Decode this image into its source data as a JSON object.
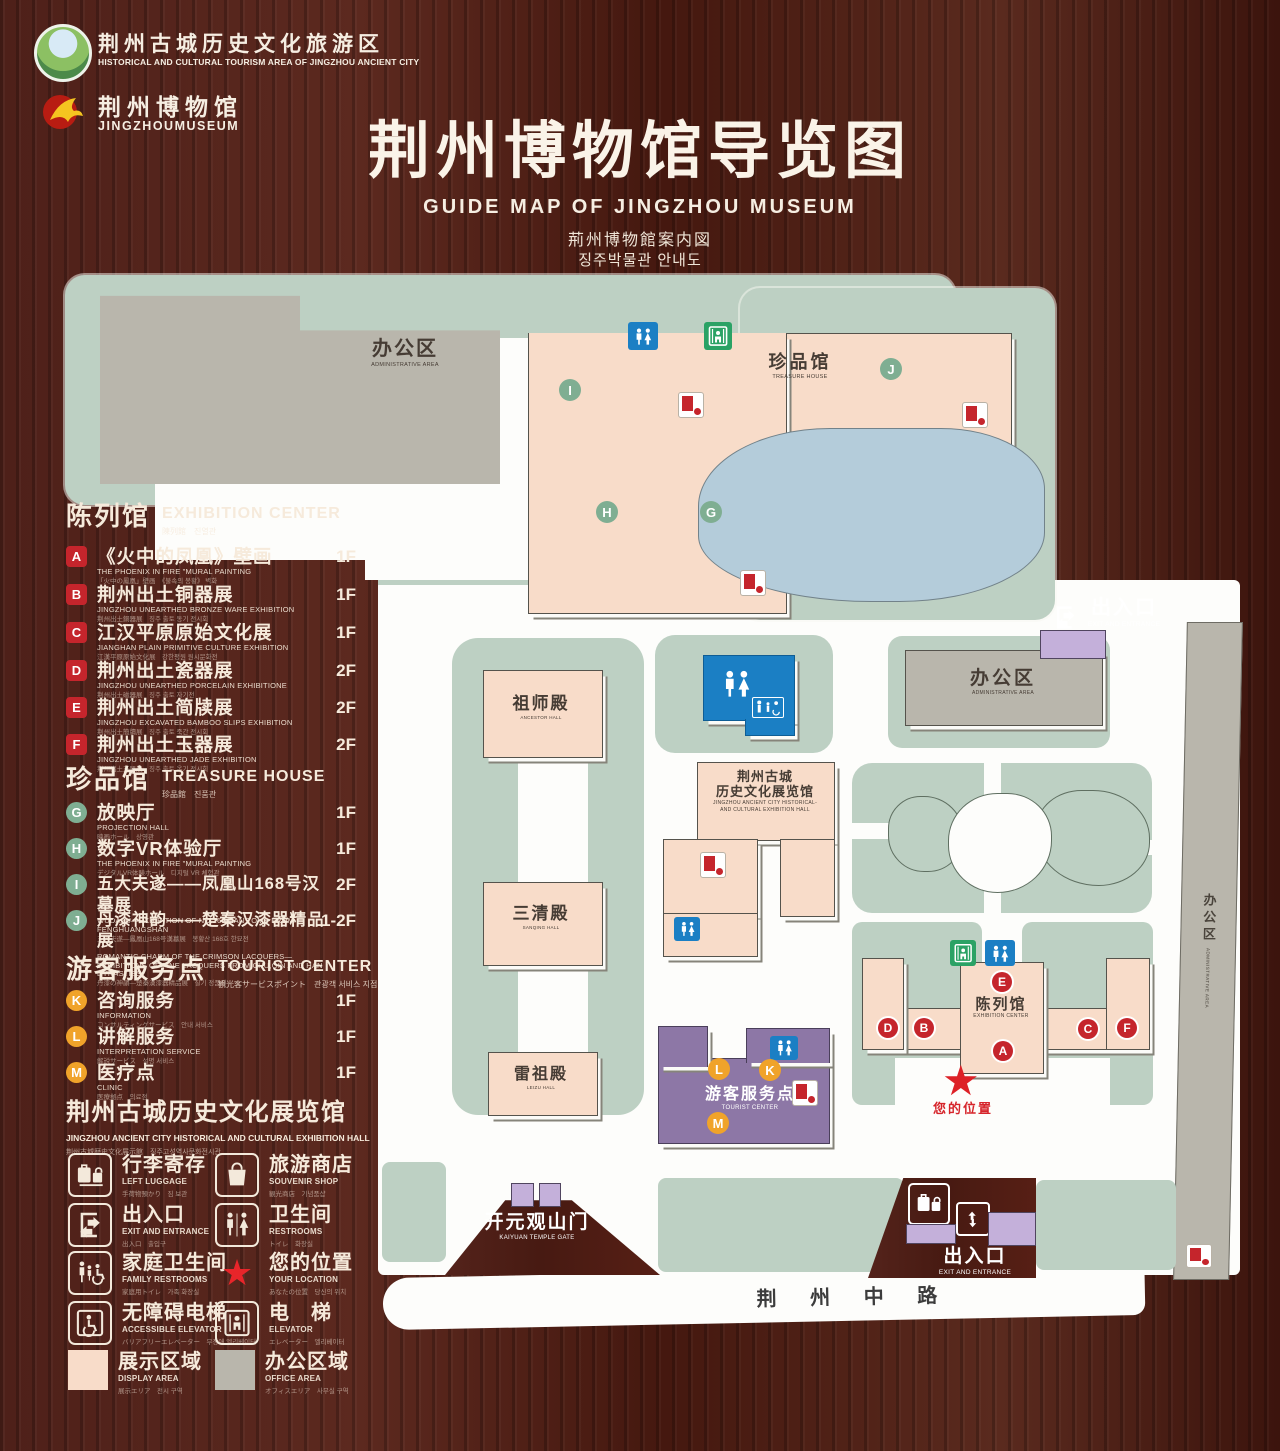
{
  "header": {
    "logo1": {
      "zh": "荆州古城历史文化旅游区",
      "en": "HISTORICAL AND CULTURAL TOURISM AREA OF JINGZHOU ANCIENT CITY"
    },
    "logo2": {
      "zh": "荆州博物馆",
      "en": "JINGZHOUMUSEUM"
    },
    "title": "荆州博物馆导览图",
    "subtitle_en": "GUIDE MAP OF JINGZHOU MUSEUM",
    "subtitle_ja": "荊州博物館案内図",
    "subtitle_ko": "징주박물관 안내도"
  },
  "sidebar": {
    "sections": [
      {
        "zh": "陈列馆",
        "en": "EXHIBITION CENTER",
        "sub": "陳列館　진열관",
        "items": [
          {
            "letter": "A",
            "zh": "《火中的凤凰》壁画",
            "en": "THE PHOENIX IN FIRE \"MURAL PAINTING",
            "sub": "「火中の鳳凰」壁画　《불속의 봉황》 벽화",
            "floor": "1F"
          },
          {
            "letter": "B",
            "zh": "荆州出土铜器展",
            "en": "JINGZHOU UNEARTHED BRONZE WARE EXHIBITION",
            "sub": "荆州出土銅器展　징주 출토 동기 전시회",
            "floor": "1F"
          },
          {
            "letter": "C",
            "zh": "江汉平原原始文化展",
            "en": "JIANGHAN PLAIN PRIMITIVE CULTURE EXHIBITION",
            "sub": "江漢平原原始文化展　강한평원 원시문화전",
            "floor": "1F"
          },
          {
            "letter": "D",
            "zh": "荆州出土瓷器展",
            "en": "JINGZHOU UNEARTHED PORCELAIN EXHIBITIONE",
            "sub": "荆州出土磁器展　징주 출토 자기전",
            "floor": "2F"
          },
          {
            "letter": "E",
            "zh": "荆州出土简牍展",
            "en": "JINGZHOU EXCAVATED BAMBOO SLIPS EXHIBITION",
            "sub": "荆州出土簡牘展　징주 출토 죽간 전시회",
            "floor": "2F"
          },
          {
            "letter": "F",
            "zh": "荆州出土玉器展",
            "en": "JINGZHOU UNEARTHED JADE EXHIBITION",
            "sub": "荆州出土玉器展　징주 출토 옥기 전시회",
            "floor": "2F"
          }
        ]
      },
      {
        "zh": "珍品馆",
        "en": "TREASURE HOUSE",
        "sub": "珍品館　진품관",
        "items": [
          {
            "letter": "G",
            "zh": "放映厅",
            "en": "PROJECTION HALL",
            "sub": "映画ホール　상영관",
            "floor": "1F"
          },
          {
            "letter": "H",
            "zh": "数字VR体验厅",
            "en": "THE PHOENIX IN FIRE \"MURAL PAINTING",
            "sub": "デジタルVR体験ホール　디지털 VR 체험관",
            "floor": "1F"
          },
          {
            "letter": "I",
            "zh": "五大夫遂——凤凰山168号汉墓展",
            "en": "WUDAFU—EXHIBITION OF NO.168 HAN TOMB FROM FENGHUANGSHAN",
            "sub": "五大夫遂—鳳凰山168号漢墓展　봉황산 168호 한묘전",
            "floor": "2F"
          },
          {
            "letter": "J",
            "zh": "丹漆神韵——楚秦汉漆器精品展",
            "en": "ROMANTIC CHARM OF THE CRIMSON LACQUERS— EXHIBITIONS OF FINE LACQUERS FROM CHU,QIN AND HAN DYNASTIES",
            "sub": "丹漆の神韻—楚秦漢漆器精品展　칠기 정품전",
            "floor": "1-2F"
          }
        ]
      },
      {
        "zh": "游客服务点",
        "en": "TOURIST CENTER",
        "sub": "観光客サービスポイント　관광객 서비스 지점",
        "items": [
          {
            "letter": "K",
            "zh": "咨询服务",
            "en": "INFORMATION",
            "sub": "コンサルティングサービス　안내 서비스",
            "floor": "1F"
          },
          {
            "letter": "L",
            "zh": "讲解服务",
            "en": "INTERPRETATION SERVICE",
            "sub": "解説サービス　설명 서비스",
            "floor": "1F"
          },
          {
            "letter": "M",
            "zh": "医疗点",
            "en": "CLINIC",
            "sub": "医療拠点　의료점",
            "floor": "1F"
          }
        ]
      }
    ],
    "hall": {
      "zh": "荆州古城历史文化展览馆",
      "en": "JINGZHOU ANCIENT CITY HISTORICAL AND CULTURAL EXHIBITION HALL",
      "sub": "荆州古城歴史文化展示館　징주고성역사문화전시관"
    },
    "legend": [
      {
        "zh": "行李寄存",
        "en": "LEFT LUGGAGE",
        "sub": "手荷物預かり　짐 보관",
        "icon": "luggage-icon"
      },
      {
        "zh": "旅游商店",
        "en": "SOUVENIR SHOP",
        "sub": "観光商店　기념품샵",
        "icon": "shopping-bag-icon"
      },
      {
        "zh": "出入口",
        "en": "EXIT AND ENTRANCE",
        "sub": "出入口　출입구",
        "icon": "exit-icon"
      },
      {
        "zh": "卫生间",
        "en": "RESTROOMS",
        "sub": "トイレ　화장실",
        "icon": "restroom-icon"
      },
      {
        "zh": "家庭卫生间",
        "en": "FAMILY RESTROOMS",
        "sub": "家庭用トイレ　가족 화장실",
        "icon": "family-restroom-icon"
      },
      {
        "zh": "您的位置",
        "en": "YOUR LOCATION",
        "sub": "あなたの位置　당신의 위치",
        "icon": "location-star-icon"
      },
      {
        "zh": "无障碍电梯",
        "en": "ACCESSIBLE ELEVATOR",
        "sub": "バリアフリーエレベーター　무장애 엘리베이터",
        "icon": "accessible-elevator-icon"
      },
      {
        "zh": "电　梯",
        "en": "ELEVATOR",
        "sub": "エレベーター　엘리베이터",
        "icon": "elevator-icon"
      },
      {
        "zh": "展示区域",
        "en": "DISPLAY AREA",
        "sub": "展示エリア　전시 구역",
        "icon": "display-area-swatch"
      },
      {
        "zh": "办公区域",
        "en": "OFFICE AREA",
        "sub": "オフィスエリア　사무실 구역",
        "icon": "office-area-swatch"
      }
    ]
  },
  "map": {
    "admin_top": {
      "zh": "办公区",
      "en": "ADMINISTRATIVE AREA"
    },
    "treasure_house": {
      "zh": "珍品馆",
      "en": "TREASURE HOUSE"
    },
    "exit_top": {
      "zh": "出入口",
      "en": "EXIT AND ENTRANCE"
    },
    "admin_right": {
      "zh": "办公区",
      "en": "ADMINISTRATIVE AREA"
    },
    "admin_strip": {
      "zh": "办公区",
      "en": "ADMINISTRATIVE AREA"
    },
    "ancestor_hall": {
      "zh": "祖师殿",
      "en": "ANCESTOR HALL"
    },
    "sanqing_hall": {
      "zh": "三清殿",
      "en": "SANQING HALL"
    },
    "leizu_hall": {
      "zh": "雷祖殿",
      "en": "LEIZU HALL"
    },
    "exhibition_hall": {
      "zh1": "荆州古城",
      "zh2": "历史文化展览馆",
      "en1": "JINGZHOU ANCIENT CITY HISTORICAL-",
      "en2": "AND CULTURAL EXHIBITION HALL"
    },
    "tourist_center": {
      "zh": "游客服务点",
      "en": "TOURIST CENTER"
    },
    "exhibition_center": {
      "zh": "陈列馆",
      "en": "EXHIBITION CENTER"
    },
    "your_location": "您的位置",
    "location_star": "★",
    "temple_gate": {
      "zh": "开元观山门",
      "en": "KAIYUAN TEMPLE GATE"
    },
    "exit_bottom": {
      "zh": "出入口",
      "en": "EXIT AND ENTRANCE"
    },
    "road": "荆 州 中 路",
    "markers": {
      "a": "A",
      "b": "B",
      "c": "C",
      "d": "D",
      "e": "E",
      "f": "F",
      "g": "G",
      "h": "H",
      "i": "I",
      "j": "J",
      "k": "K",
      "l": "L",
      "m": "M"
    }
  },
  "colors": {
    "accent_red": "#c5252c",
    "badge_green": "#7fae92",
    "badge_yellow": "#f0a32a",
    "display_area_pink": "#f8dcc9",
    "office_area_gray": "#b9b6ac",
    "campus_green": "#bdd0c3",
    "lake_blue": "#b4ccda",
    "tourist_purple": "#8d77a6",
    "gate_purple": "#c4b0da",
    "restroom_blue": "#1b7fc4",
    "exit_green": "#2aa265",
    "wood_brown": "#4e2019"
  }
}
